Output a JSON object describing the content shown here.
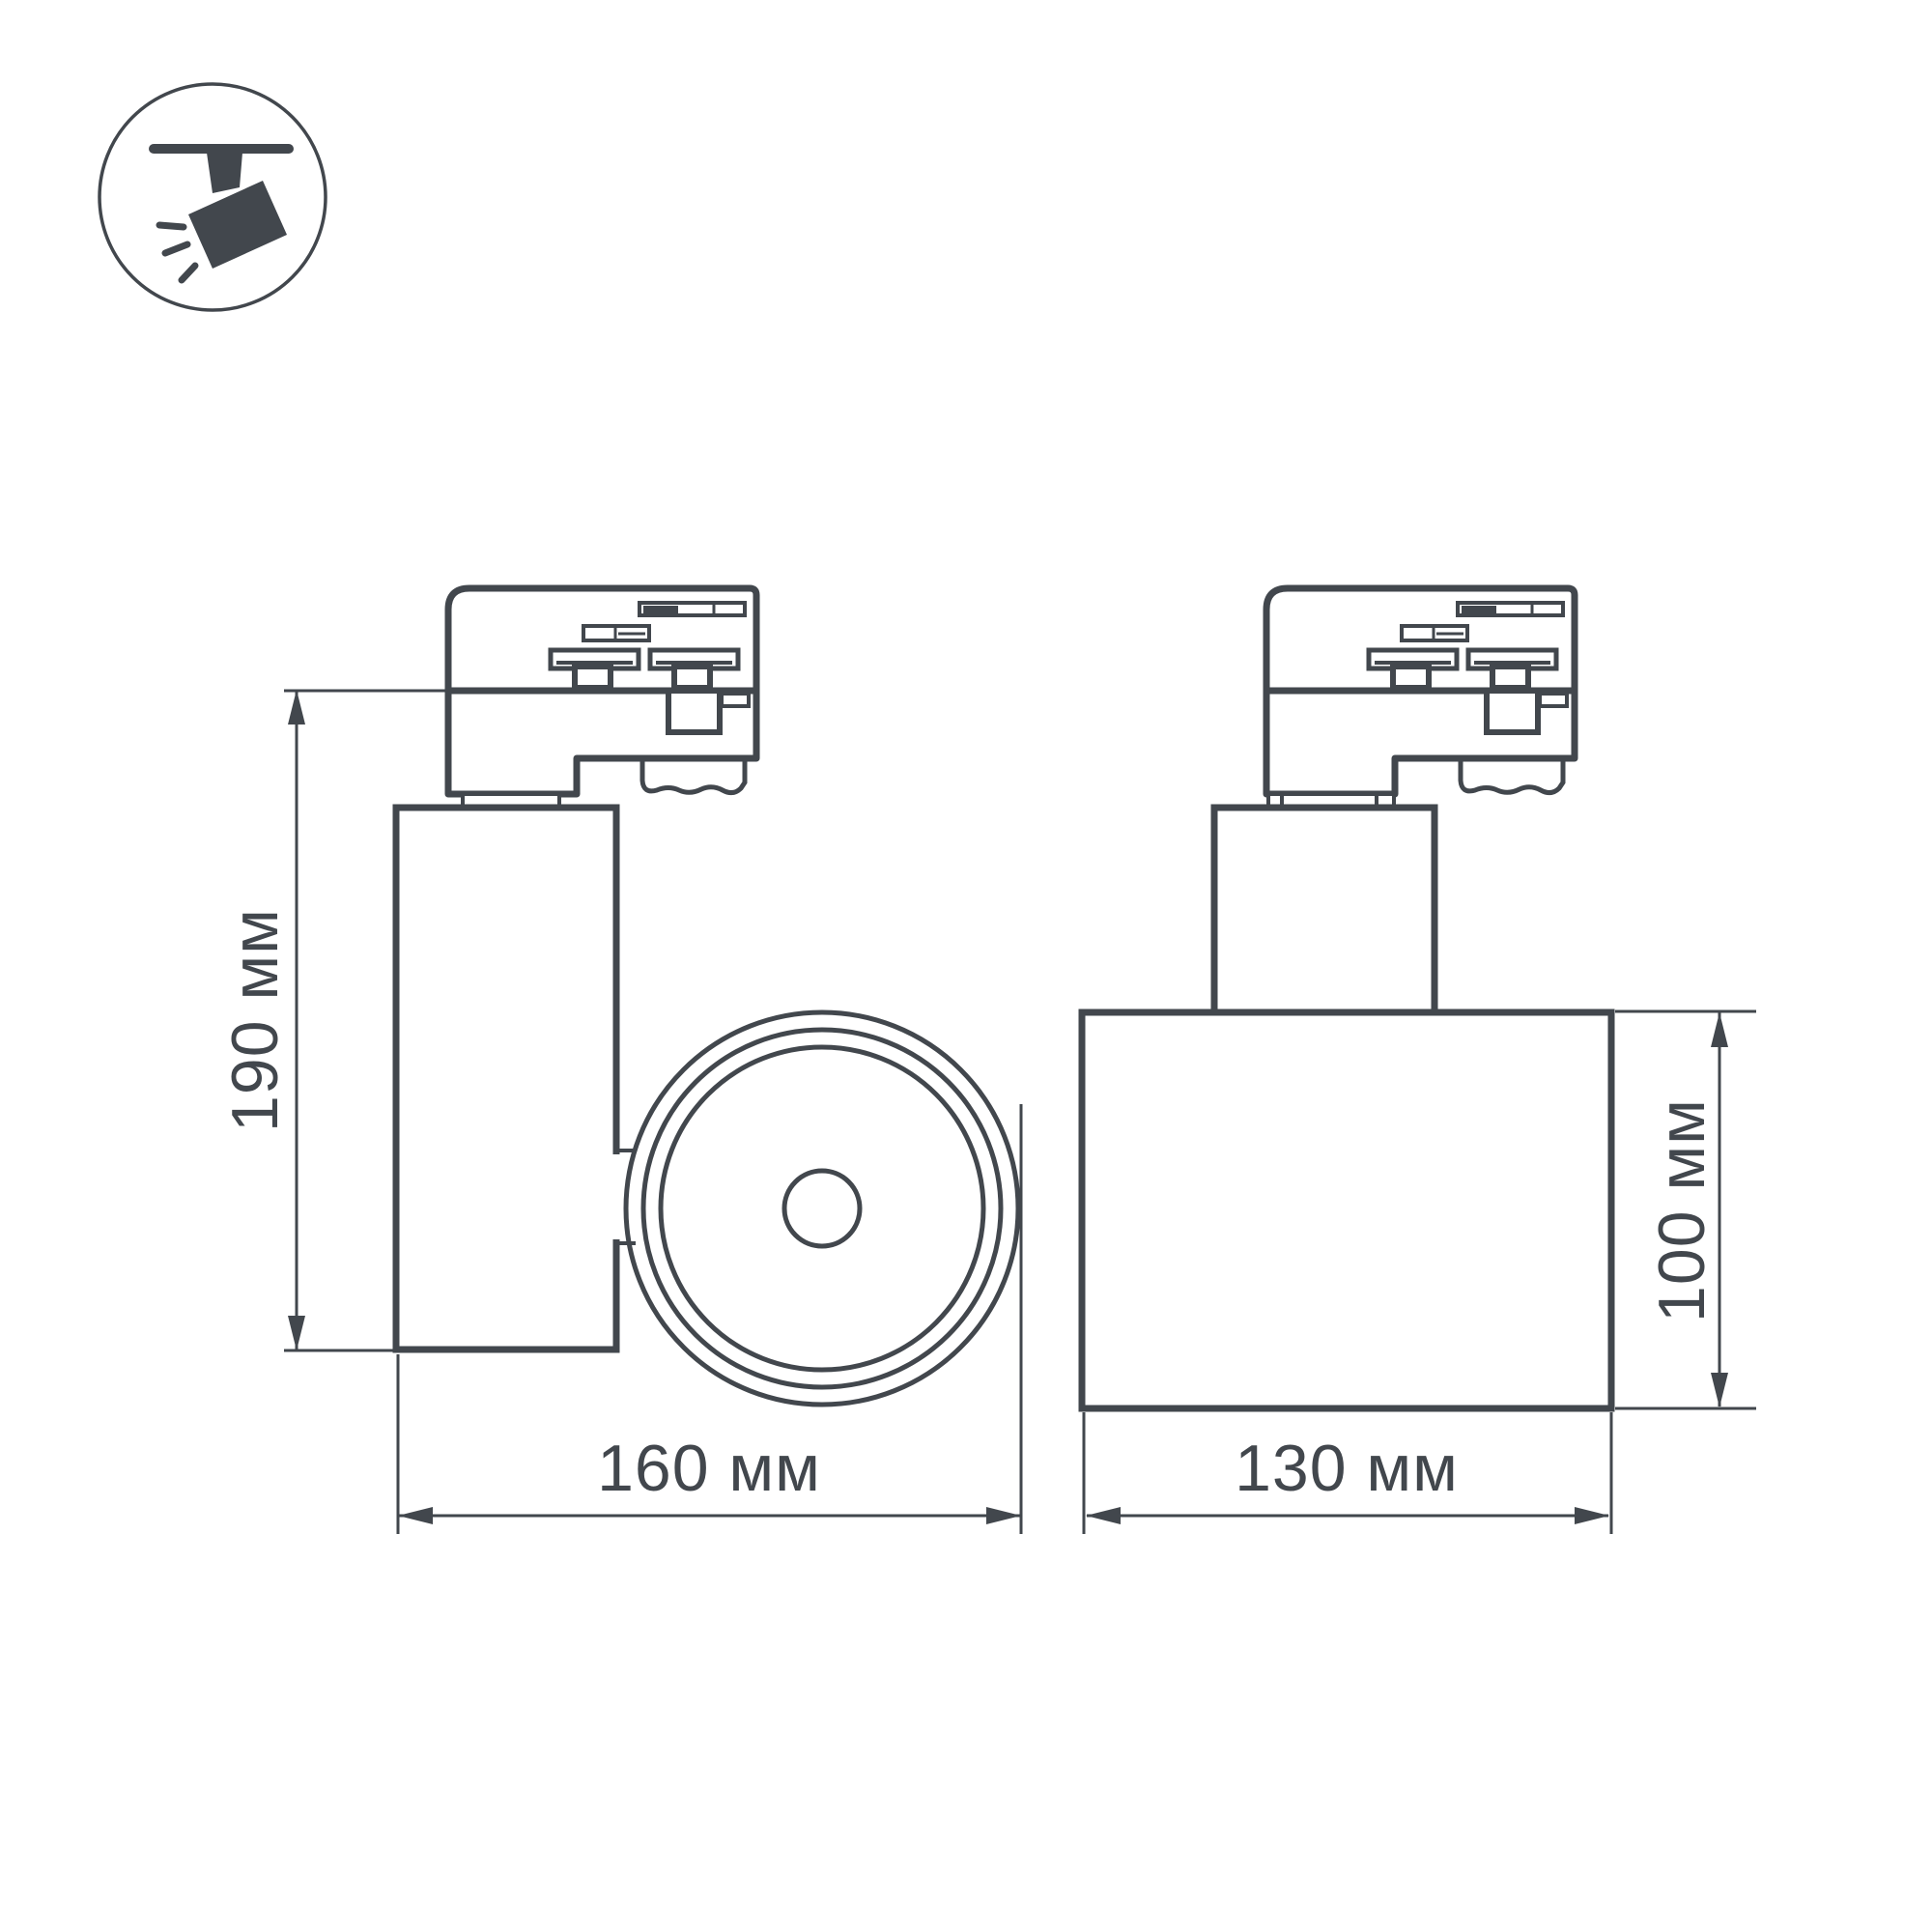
{
  "icon": {
    "name": "track-spotlight-icon"
  },
  "views": {
    "side": {
      "name": "side-view",
      "height_label": "190 мм",
      "width_label": "160 мм"
    },
    "back": {
      "name": "back-view",
      "height_label": "100 мм",
      "width_label": "130 мм"
    }
  },
  "colors": {
    "line": "#42474d",
    "background": "#ffffff"
  }
}
